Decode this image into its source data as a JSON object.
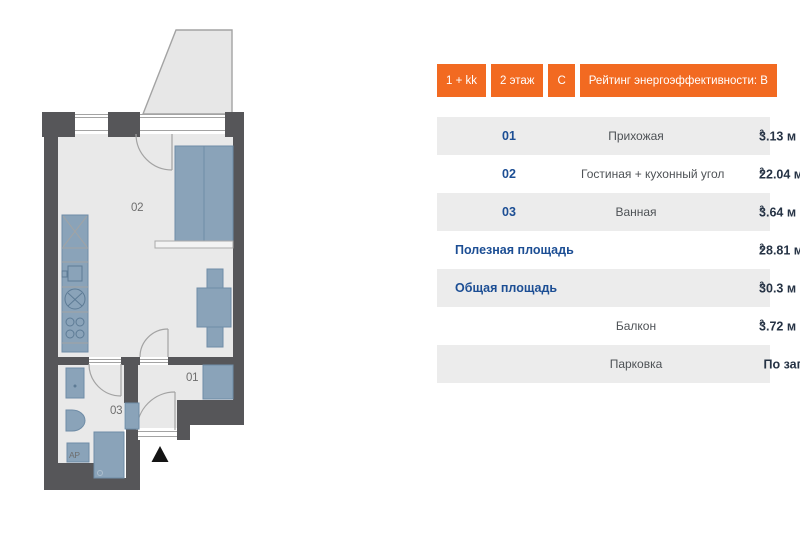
{
  "colors": {
    "wall": "#565659",
    "floor": "#e9e9e9",
    "balcony": "#e7e7e7",
    "furniture": "#8aa3b9",
    "furniture_border": "#6f8ca6",
    "line": "#a3a3a3",
    "label": "#6e6e6e",
    "badge": "#f26a21",
    "row_shade": "#ececec",
    "num_blue": "#1c4e94",
    "name_gray": "#4e5256",
    "value_dark": "#263345"
  },
  "floor_plan": {
    "room_labels": {
      "living": "02",
      "hall": "01",
      "bath": "03",
      "appliance": "AP"
    }
  },
  "badges": [
    {
      "label": "1 + kk"
    },
    {
      "label": "2 этаж"
    },
    {
      "label": "C"
    },
    {
      "label": "Рейтинг энергоэффективности: B"
    }
  ],
  "table": {
    "rows": [
      {
        "num": "01",
        "label": "Прихожая",
        "value": "3.13 м",
        "sup": "2"
      },
      {
        "num": "02",
        "label": "Гостиная + кухонный угол",
        "value": "22.04 м",
        "sup": "2"
      },
      {
        "num": "03",
        "label": "Ванная",
        "value": "3.64 м",
        "sup": "2"
      },
      {
        "total": "Полезная площадь",
        "value": "28.81 м",
        "sup": "2"
      },
      {
        "total": "Общая площадь",
        "value": "30.3 м",
        "sup": "2"
      },
      {
        "label": "Балкон",
        "value": "3.72 м",
        "sup": "2"
      },
      {
        "label": "Парковка",
        "value": "По запросу",
        "sup": ""
      }
    ]
  }
}
